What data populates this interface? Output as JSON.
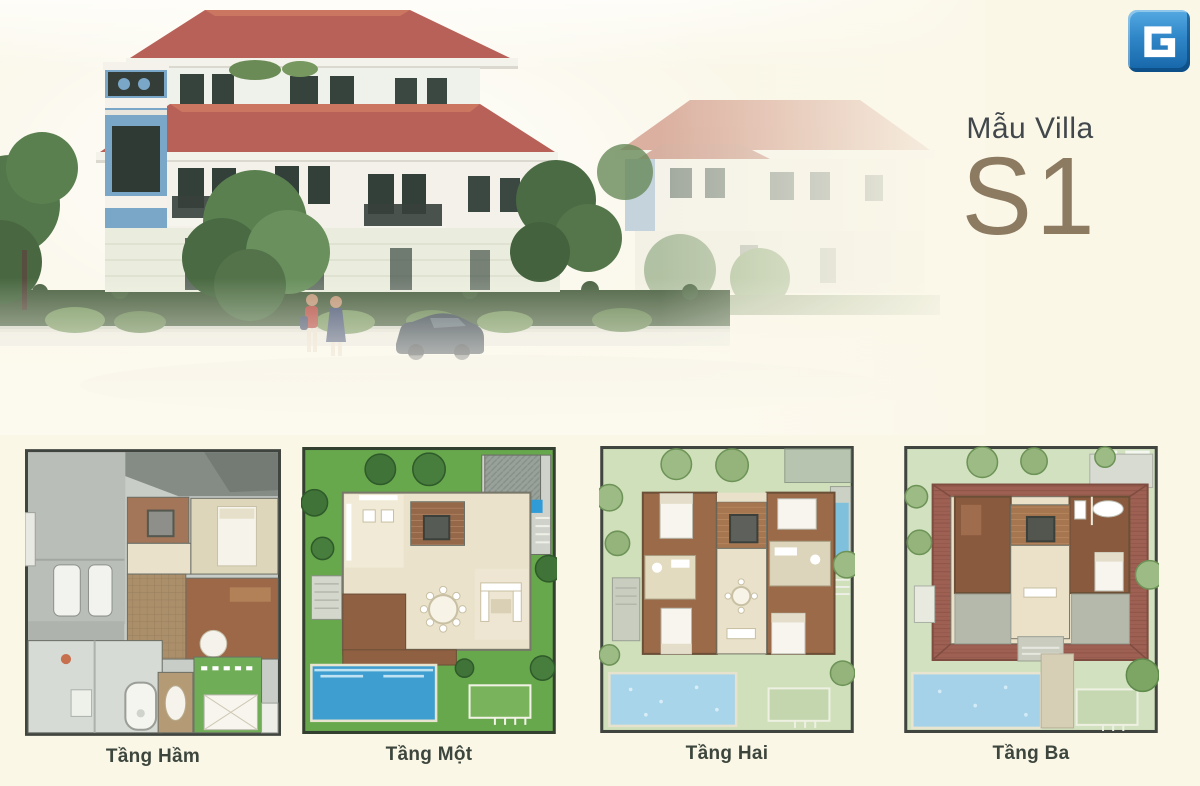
{
  "header": {
    "model_label": "Mẫu Villa",
    "model_code": "S1"
  },
  "logo": {
    "letter": "G"
  },
  "floor_plans": [
    {
      "label": "Tầng Hầm"
    },
    {
      "label": "Tầng Một"
    },
    {
      "label": "Tầng Hai"
    },
    {
      "label": "Tầng Ba"
    }
  ],
  "colors": {
    "background": "#FAF7E7",
    "title_text": "#41474B",
    "model_code_text": "#8C7A61",
    "plan_label_text": "#3D463D",
    "logo_blue": "#2B7BC0",
    "roof_red": "#B2544A",
    "villa_accent_blue": "#6F9FC4",
    "garden_green": "#68A84D",
    "pool_blue": "#3F9ED0",
    "pale_green": "#CFE0BA",
    "room_brown": "#9A6A49"
  }
}
